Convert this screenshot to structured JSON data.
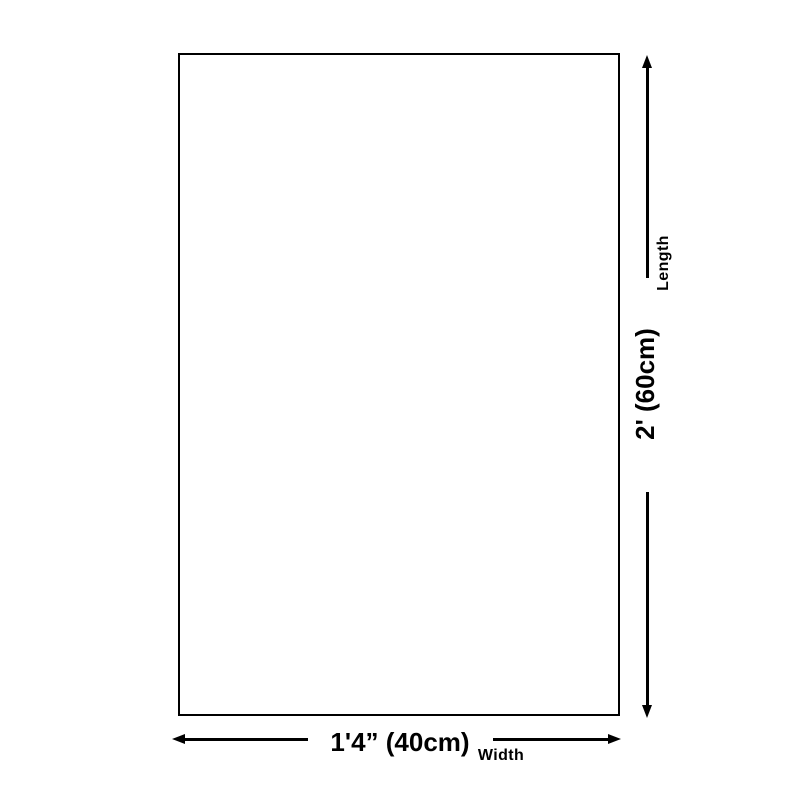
{
  "dimension_diagram": {
    "vertical": {
      "axis_label": "Length",
      "value": "2' (60cm)"
    },
    "horizontal": {
      "axis_label": "Width",
      "value": "1'4” (40cm)"
    },
    "colors": {
      "line": "#000000",
      "text": "#000000",
      "background": "#ffffff"
    }
  }
}
